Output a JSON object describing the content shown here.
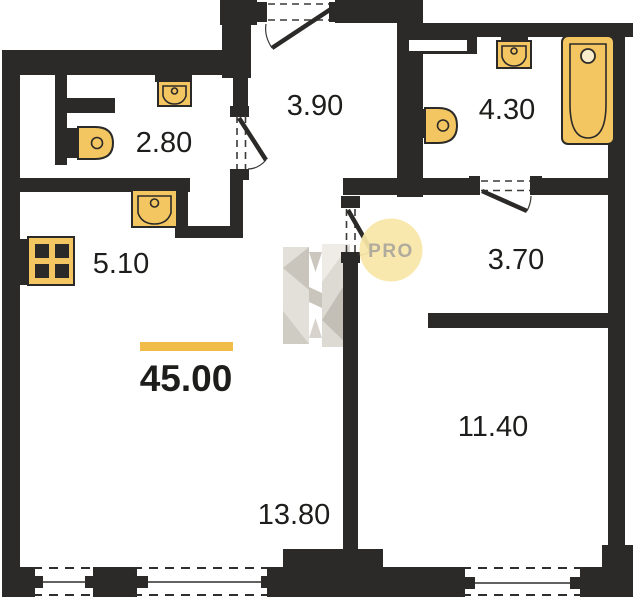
{
  "floorplan": {
    "total_area": "45.00",
    "rooms": [
      {
        "id": "wc",
        "area": "2.80"
      },
      {
        "id": "entry-hall",
        "area": "3.90"
      },
      {
        "id": "bathroom",
        "area": "4.30"
      },
      {
        "id": "kitchen",
        "area": "5.10"
      },
      {
        "id": "inner-hall",
        "area": "3.70"
      },
      {
        "id": "bedroom",
        "area": "11.40"
      },
      {
        "id": "living-room",
        "area": "13.80"
      }
    ],
    "watermark": {
      "brand_letter": "H",
      "badge": "PRO"
    },
    "icons": [
      "stove-icon",
      "sink-icon",
      "toilet-icon",
      "bathtub-icon",
      "door-swing-icon",
      "window-icon"
    ],
    "colors": {
      "wall": "#2b2a28",
      "fixture-fill": "#f4c662",
      "fixture-stroke": "#2b2a28",
      "area-bar": "#f2bc49",
      "label-text": "#1d1d1b",
      "badge-fill": "#f8e6a7",
      "badge-text": "#b1ab9e"
    }
  }
}
